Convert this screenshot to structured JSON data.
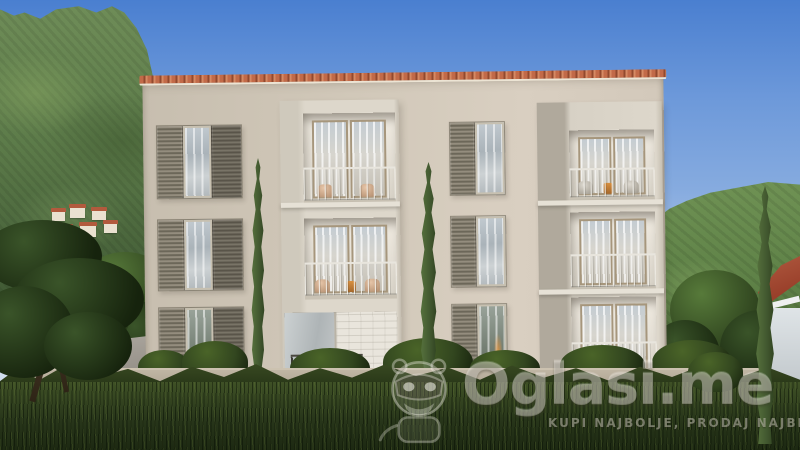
{
  "meta": {
    "type": "architectural-rendering-photo",
    "subject": "Three-storey cream apartment building with louvered shutters and recessed balconies",
    "setting": "Green mountainside with hillside village, cypress trees, boundary wall, wild grass and clear blue sky"
  },
  "watermark": {
    "brand": "Oglasi.me",
    "slogan": "KUPI NAJBOLJE, PRODAJ NAJBRŽE",
    "mascot": "masked-mascot-icon"
  },
  "palette": {
    "sky_top": "#4a7fd0",
    "sky_mid": "#86abdf",
    "sky_horizon": "#cfdcee",
    "mountain": "#5d7c4a",
    "mountain_dark": "#3e5733",
    "hill": "#5d8046",
    "facade": "#d1c8b9",
    "frame_face": "#ddd7cb",
    "frame_side": "#b0a99c",
    "inner_wall": "#e5e0d6",
    "shutter": "#8b8577",
    "shutter_dark": "#6e695c",
    "glass": "#b7c0c6",
    "door_frame": "#a6967c",
    "roof_tile": "#b85c3e",
    "boundary_wall": "#a89e8d",
    "grass": "#3f5126",
    "grass_dark": "#1d2912",
    "bush": "#32461f",
    "cypress": "#41572f",
    "cypress_dark": "#243517",
    "pine": "#2b4122",
    "village_wall": "#eae1d0",
    "village_roof": "#b25a3d",
    "neighbor_roof": "#993f2a",
    "neighbor_wall": "#dfe4e7",
    "road": "#97928a",
    "watermark_tint": "#f0ede5"
  }
}
